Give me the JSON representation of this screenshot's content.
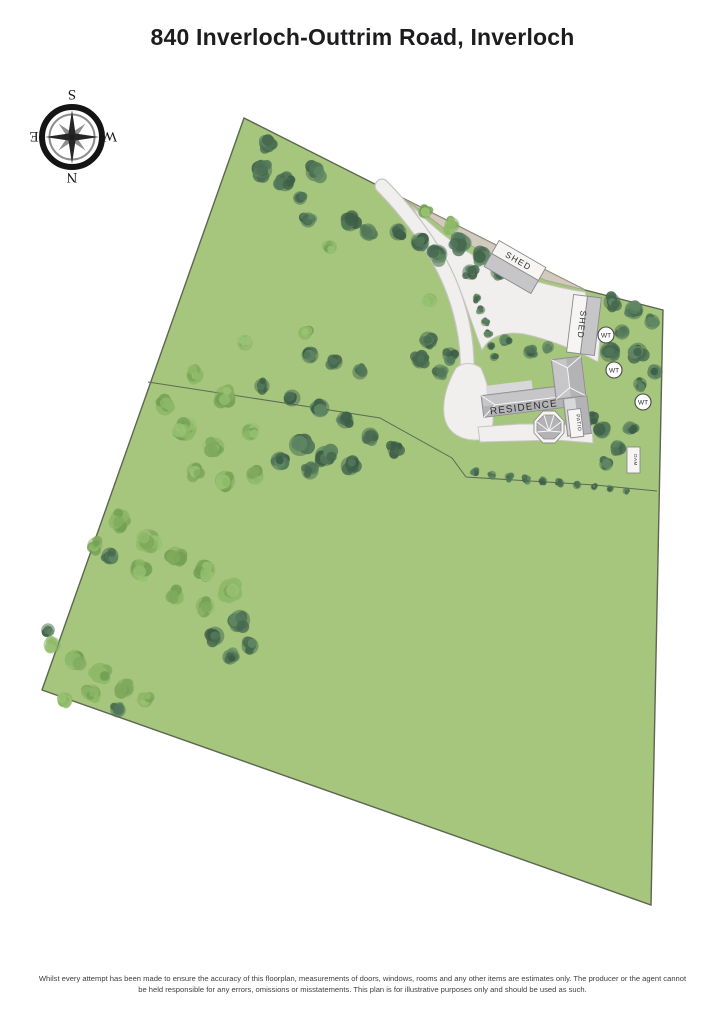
{
  "title": "840 Inverloch-Outtrim Road, Inverloch",
  "compass": {
    "n": "N",
    "e": "E",
    "s": "S",
    "w": "W"
  },
  "plan": {
    "residence_label": "RESIDENCE",
    "shed1_label": "SHED",
    "shed2_label": "SHED",
    "patio_label": "PATIO",
    "wt_label": "WT",
    "dam_label": "DAM"
  },
  "disclaimer": {
    "line1": "Whilst every attempt has been made to ensure the accuracy of this floorplan, measurements of doors, windows, rooms and any other items are estimates only. The producer or the agent cannot",
    "line2": "be held responsible for any errors, omissions or misstatements. This plan is for illustrative purposes only and should be used as such."
  },
  "map": {
    "colors": {
      "field": "#a5c67c",
      "boundary": "#5c6650",
      "fence": "#5f6a54",
      "driveway": "#f0efed",
      "driveway_border": "#c8c6c2",
      "gravel": "#d3cabe",
      "gravel_border": "#ab9f8e",
      "roof": "#b3b2b4",
      "roof_light": "#c6c5c7",
      "roof_lighter": "#d8d7d9",
      "shed_gray": "#c6c5c7",
      "structure_white": "#f6f5f3",
      "outline": "#8b8a8c"
    },
    "tree_palettes": {
      "d": [
        "#46684f",
        "#527759",
        "#5f8763",
        "#3d5d46"
      ],
      "l": [
        "#7fa95c",
        "#8db968",
        "#99c274",
        "#72a053"
      ]
    },
    "trees": [
      [
        268,
        144,
        10,
        "d"
      ],
      [
        262,
        170,
        12,
        "d"
      ],
      [
        285,
        182,
        11,
        "d"
      ],
      [
        315,
        172,
        11,
        "d"
      ],
      [
        300,
        198,
        8,
        "d"
      ],
      [
        308,
        220,
        9,
        "d"
      ],
      [
        350,
        222,
        11,
        "d"
      ],
      [
        368,
        232,
        10,
        "d"
      ],
      [
        398,
        232,
        10,
        "d"
      ],
      [
        420,
        242,
        11,
        "d"
      ],
      [
        438,
        254,
        11,
        "d"
      ],
      [
        460,
        243,
        12,
        "d"
      ],
      [
        482,
        256,
        11,
        "d"
      ],
      [
        470,
        272,
        9,
        "d"
      ],
      [
        498,
        272,
        9,
        "d"
      ],
      [
        505,
        263,
        8,
        "d"
      ],
      [
        452,
        225,
        9,
        "l"
      ],
      [
        425,
        212,
        8,
        "l"
      ],
      [
        330,
        247,
        8,
        "l"
      ],
      [
        430,
        300,
        8,
        "l"
      ],
      [
        245,
        343,
        9,
        "l"
      ],
      [
        305,
        333,
        8,
        "l"
      ],
      [
        195,
        375,
        10,
        "l"
      ],
      [
        225,
        396,
        12,
        "l"
      ],
      [
        165,
        406,
        11,
        "l"
      ],
      [
        185,
        430,
        13,
        "l"
      ],
      [
        215,
        447,
        11,
        "l"
      ],
      [
        250,
        432,
        10,
        "l"
      ],
      [
        255,
        476,
        10,
        "l"
      ],
      [
        225,
        481,
        12,
        "l"
      ],
      [
        195,
        471,
        10,
        "l"
      ],
      [
        262,
        386,
        9,
        "d"
      ],
      [
        292,
        398,
        10,
        "d"
      ],
      [
        320,
        408,
        11,
        "d"
      ],
      [
        345,
        420,
        10,
        "d"
      ],
      [
        310,
        355,
        10,
        "d"
      ],
      [
        335,
        362,
        9,
        "d"
      ],
      [
        360,
        372,
        9,
        "d"
      ],
      [
        300,
        445,
        13,
        "d"
      ],
      [
        325,
        456,
        12,
        "d"
      ],
      [
        350,
        466,
        11,
        "d"
      ],
      [
        310,
        471,
        10,
        "d"
      ],
      [
        280,
        461,
        11,
        "d"
      ],
      [
        370,
        436,
        10,
        "d"
      ],
      [
        395,
        449,
        9,
        "d"
      ],
      [
        420,
        360,
        10,
        "d"
      ],
      [
        440,
        372,
        9,
        "d"
      ],
      [
        428,
        340,
        10,
        "d"
      ],
      [
        450,
        355,
        9,
        "d"
      ],
      [
        477,
        298,
        5,
        "d"
      ],
      [
        481,
        310,
        5,
        "d"
      ],
      [
        485,
        322,
        5,
        "d"
      ],
      [
        488,
        334,
        5,
        "d"
      ],
      [
        491,
        346,
        5,
        "d"
      ],
      [
        494,
        357,
        5,
        "d"
      ],
      [
        530,
        352,
        8,
        "d"
      ],
      [
        548,
        347,
        7,
        "d"
      ],
      [
        505,
        340,
        7,
        "d"
      ],
      [
        612,
        302,
        10,
        "d"
      ],
      [
        634,
        310,
        11,
        "d"
      ],
      [
        652,
        322,
        9,
        "d"
      ],
      [
        622,
        332,
        9,
        "d"
      ],
      [
        610,
        352,
        12,
        "d"
      ],
      [
        638,
        352,
        11,
        "d"
      ],
      [
        655,
        372,
        9,
        "d"
      ],
      [
        640,
        384,
        8,
        "d"
      ],
      [
        602,
        430,
        10,
        "d"
      ],
      [
        618,
        448,
        9,
        "d"
      ],
      [
        606,
        464,
        8,
        "d"
      ],
      [
        630,
        428,
        8,
        "d"
      ],
      [
        592,
        418,
        8,
        "d"
      ],
      [
        475,
        472,
        5,
        "d"
      ],
      [
        492,
        475,
        5,
        "d"
      ],
      [
        509,
        477,
        5,
        "d"
      ],
      [
        526,
        479,
        5,
        "d"
      ],
      [
        543,
        481,
        5,
        "d"
      ],
      [
        560,
        483,
        5,
        "d"
      ],
      [
        577,
        485,
        5,
        "d"
      ],
      [
        594,
        487,
        4,
        "d"
      ],
      [
        610,
        489,
        4,
        "d"
      ],
      [
        626,
        491,
        4,
        "d"
      ],
      [
        120,
        520,
        12,
        "l"
      ],
      [
        148,
        540,
        13,
        "l"
      ],
      [
        175,
        556,
        11,
        "l"
      ],
      [
        140,
        570,
        12,
        "l"
      ],
      [
        205,
        570,
        12,
        "l"
      ],
      [
        230,
        590,
        13,
        "l"
      ],
      [
        205,
        606,
        11,
        "l"
      ],
      [
        175,
        596,
        10,
        "l"
      ],
      [
        95,
        545,
        9,
        "l"
      ],
      [
        110,
        556,
        10,
        "d"
      ],
      [
        240,
        620,
        12,
        "d"
      ],
      [
        215,
        636,
        11,
        "d"
      ],
      [
        250,
        646,
        10,
        "d"
      ],
      [
        230,
        657,
        9,
        "d"
      ],
      [
        52,
        645,
        10,
        "l"
      ],
      [
        75,
        660,
        12,
        "l"
      ],
      [
        100,
        673,
        12,
        "l"
      ],
      [
        125,
        688,
        11,
        "l"
      ],
      [
        92,
        693,
        10,
        "l"
      ],
      [
        65,
        700,
        9,
        "l"
      ],
      [
        145,
        700,
        9,
        "l"
      ],
      [
        118,
        710,
        9,
        "d"
      ],
      [
        48,
        630,
        8,
        "d"
      ]
    ]
  }
}
